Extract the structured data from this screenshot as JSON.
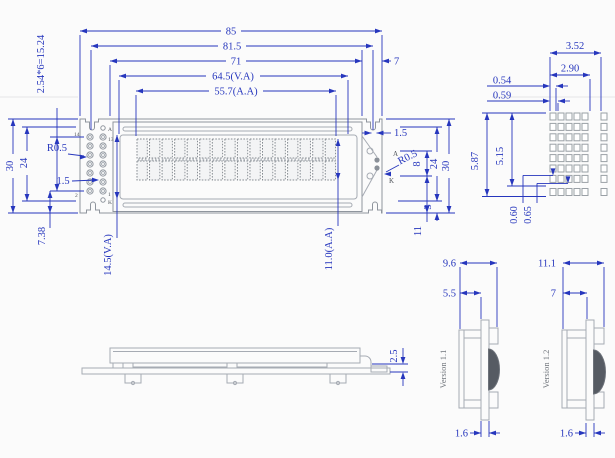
{
  "front": {
    "top": [
      "85",
      "81.5",
      "71",
      "64.5(V.A)",
      "55.7(A.A)",
      "7"
    ],
    "left": {
      "pitch": "2.54*6=15.24",
      "h30": "30",
      "h24": "24",
      "r": "R0.5",
      "gap": "1.5",
      "off": "7.38"
    },
    "bottom": {
      "va": "14.5(V.A)",
      "aa": "11.0(A.A)"
    },
    "right": {
      "notch": "1.5",
      "r": "R0.5",
      "ak8": "8",
      "h24": "24",
      "h30": "30",
      "e3": "3",
      "b11": "11"
    },
    "pins": {
      "p14": "14",
      "p13": "13",
      "p2": "2",
      "p1": "1",
      "a": "A",
      "k": "K"
    },
    "bl": {
      "a": "A",
      "k": "K"
    },
    "display": {
      "cols": 16,
      "rows": 2
    }
  },
  "detail": {
    "px": "3.52",
    "ax": "2.90",
    "dw": "0.54",
    "dpx": "0.59",
    "py": "5.87",
    "ay": "5.15",
    "dh": "0.60",
    "dpy": "0.65",
    "grid": {
      "cols": 5,
      "rows": 7,
      "extra_col": 1,
      "extra_row": 1
    }
  },
  "side": {
    "step": "2.5"
  },
  "sections": [
    {
      "label": "Version 1.1",
      "total": "9.6",
      "front": "5.5",
      "pcb": "1.6"
    },
    {
      "label": "Version 1.2",
      "total": "11.1",
      "front": "7",
      "pcb": "1.6"
    }
  ],
  "colors": {
    "dim": "#2636bd",
    "part": "#a6abb3",
    "partDark": "#8f959d",
    "label": "#50555b",
    "gray": "#70757c"
  }
}
